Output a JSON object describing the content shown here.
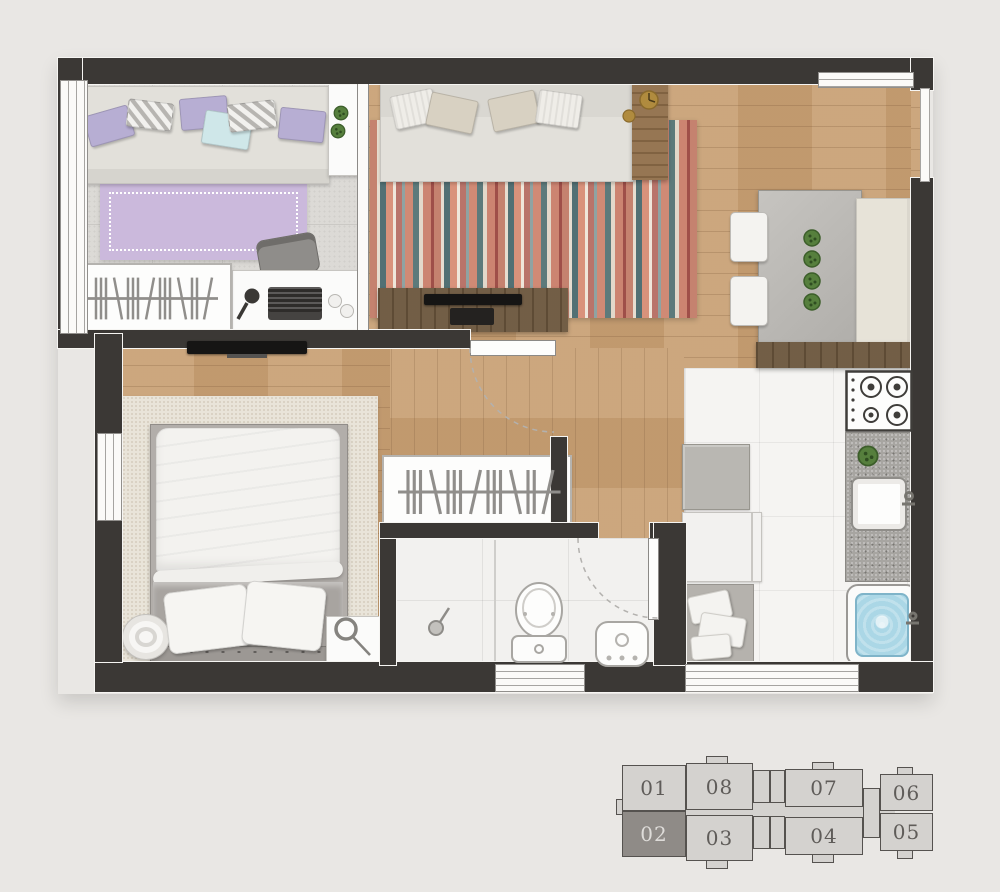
{
  "title": "apartment-floor-plan-top-view",
  "theme": {
    "bg": "#e9e7e4",
    "wall": "#3b3835",
    "wood": "#c8a074",
    "office-tile": "#dcdad6",
    "white-tile": "#f5f4f2",
    "bath-tile": "#f2f1ef",
    "rug-lilac": "#cbb9dc",
    "rug-cream": "#e9e4d9",
    "sofa": "#e2e0da",
    "pillow-lilac": "#b7aed3",
    "pillow-blue": "#cfe7e9",
    "green": "#4e7c3a",
    "water": "#abd7e6",
    "granite": "#a7a5a1",
    "dark-wood": "#6b553c",
    "mid-wood": "#8f6d48",
    "kp-fill": "#d4d2cf",
    "kp-sel": "#8f8b87",
    "kp-border": "#55524f",
    "kp-text": "#5f5c59",
    "kp-text-sel": "#dedcd9"
  },
  "rooms": {
    "office": [
      "sofa-daybed",
      "lilac-rug",
      "desk-with-laptop",
      "office-chair",
      "clothes-rack",
      "side-table-plants"
    ],
    "living": [
      "sofa",
      "striped-rug",
      "tv-console",
      "side-table-clock"
    ],
    "dining": [
      "table",
      "two-chairs",
      "bench",
      "four-plants",
      "sideboard"
    ],
    "bedroom": [
      "double-bed",
      "cream-rug",
      "wall-tv",
      "round-tray",
      "nightstand-lamp",
      "clothes-rack"
    ],
    "bathroom": [
      "shower",
      "toilet",
      "washbasin",
      "door"
    ],
    "kitchen": [
      "stove",
      "granite-counter-sink",
      "laundry-tub",
      "cabinet",
      "refrigerator",
      "laundry-basket"
    ]
  },
  "keyplan": {
    "selected_unit": "02",
    "units": [
      {
        "label": "01",
        "selected": false
      },
      {
        "label": "08",
        "selected": false
      },
      {
        "label": "07",
        "selected": false
      },
      {
        "label": "06",
        "selected": false
      },
      {
        "label": "02",
        "selected": true
      },
      {
        "label": "03",
        "selected": false
      },
      {
        "label": "04",
        "selected": false
      },
      {
        "label": "05",
        "selected": false
      }
    ]
  }
}
